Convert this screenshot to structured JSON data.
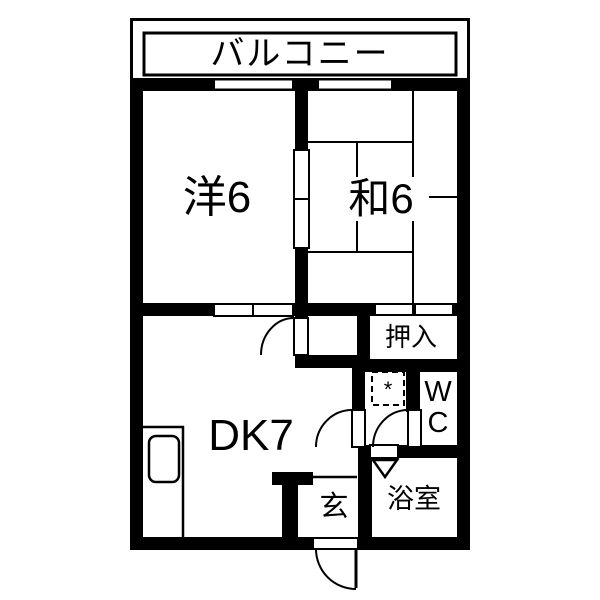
{
  "colors": {
    "wall": "#000000",
    "background": "#ffffff"
  },
  "floorplan": {
    "balcony_label": "バルコニー",
    "western_room_label": "洋6",
    "japanese_room_label": "和6",
    "closet_label": "押入",
    "dining_kitchen_label": "DK7",
    "wc_line1": "W",
    "wc_line2": "C",
    "entrance_label": "玄",
    "bathroom_label": "浴室",
    "washer_symbol": "*"
  }
}
